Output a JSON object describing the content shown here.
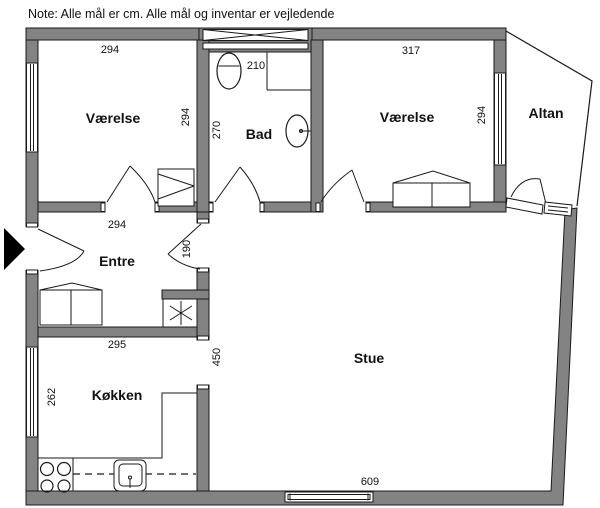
{
  "note": "Note: Alle mål er cm. Alle mål og inventar er vejledende",
  "rooms": {
    "bedroom_left": {
      "label": "Værelse"
    },
    "bathroom": {
      "label": "Bad"
    },
    "bedroom_right": {
      "label": "Værelse"
    },
    "balcony": {
      "label": "Altan"
    },
    "hall": {
      "label": "Entre"
    },
    "kitchen": {
      "label": "Køkken"
    },
    "living_room": {
      "label": "Stue"
    }
  },
  "dimensions": {
    "bedroom_left_width": "294",
    "bedroom_left_depth": "294",
    "bathroom_width": "210",
    "bathroom_depth": "270",
    "bedroom_right_width": "317",
    "bedroom_right_depth": "294",
    "hall_width": "294",
    "hall_opening": "190",
    "kitchen_width": "295",
    "kitchen_depth": "262",
    "living_room_left": "450",
    "living_room_width": "609"
  },
  "colors": {
    "wall_fill": "#838383",
    "line_color": "#1a1a1a",
    "background": "#ffffff"
  }
}
